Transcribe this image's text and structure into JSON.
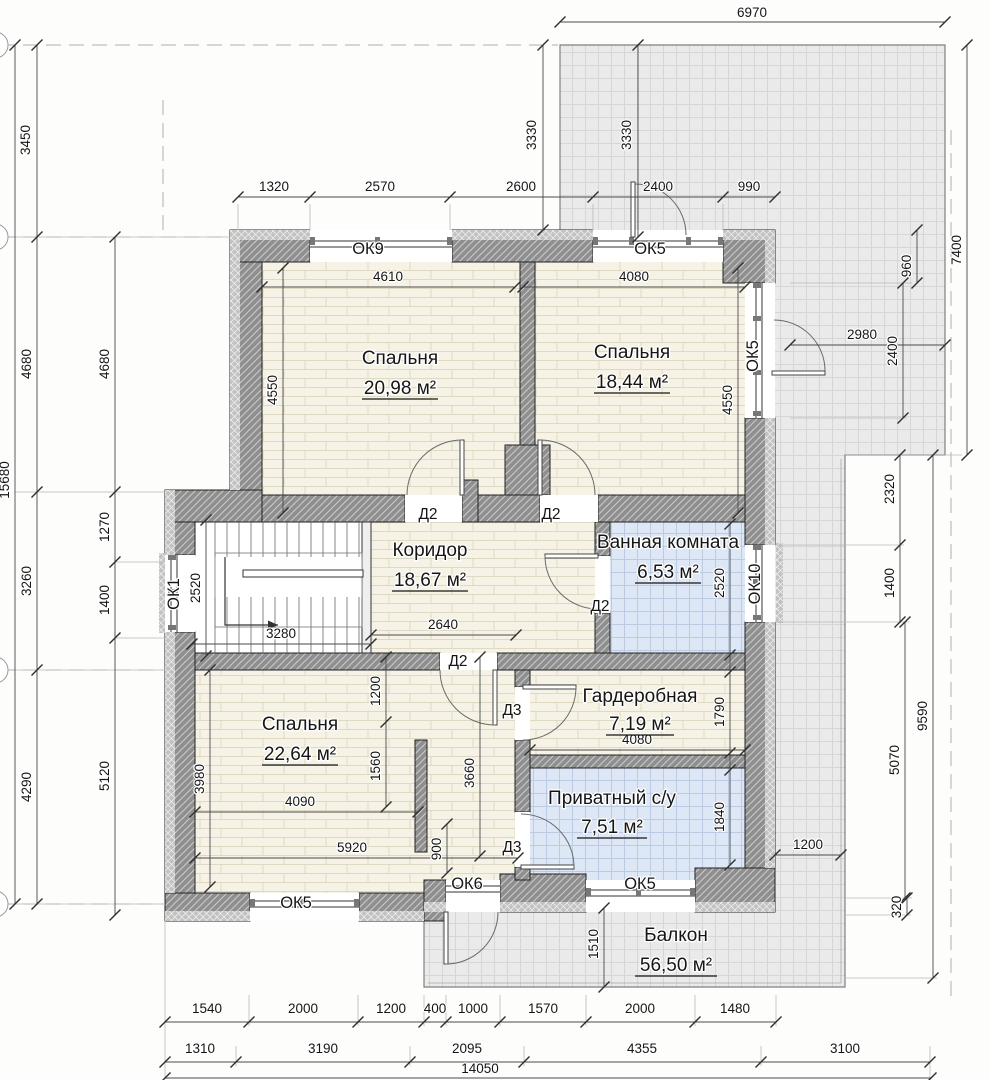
{
  "rooms": [
    {
      "name": "Спальня",
      "area": "20,98 м²"
    },
    {
      "name": "Спальня",
      "area": "18,44 м²"
    },
    {
      "name": "Коридор",
      "area": "18,67 м²"
    },
    {
      "name": "Ванная комната",
      "area": "6,53 м²"
    },
    {
      "name": "Гардеробная",
      "area": "7,19 м²"
    },
    {
      "name": "Приватный с/у",
      "area": "7,51 м²"
    },
    {
      "name": "Спальня",
      "area": "22,64 м²"
    },
    {
      "name": "Балкон",
      "area": "56,50 м²"
    }
  ],
  "windows": [
    "ОК9",
    "ОК5",
    "ОК5",
    "ОК10",
    "ОК1",
    "ОК5",
    "ОК6",
    "ОК5"
  ],
  "doors": [
    "Д2",
    "Д2",
    "Д2",
    "Д2",
    "Д3",
    "Д3"
  ],
  "dims": {
    "top": [
      "6970",
      "3450",
      "3330",
      "3330",
      "1320",
      "2570",
      "2600",
      "2400",
      "990"
    ],
    "left_outer": [
      "15680",
      "4680",
      "3260",
      "4290"
    ],
    "left_inner": [
      "4680",
      "1270",
      "1400",
      "5120"
    ],
    "right": [
      "7400",
      "960",
      "2980",
      "2400",
      "2320",
      "1400",
      "9590",
      "5070",
      "1200",
      "320"
    ],
    "bottom_row1": [
      "1540",
      "2000",
      "1200",
      "400",
      "1000",
      "1570",
      "2000",
      "1480"
    ],
    "bottom_row2": [
      "1310",
      "3190",
      "2095",
      "4355",
      "3100"
    ],
    "bottom_total": "14050",
    "interior": [
      "4610",
      "4550",
      "4080",
      "4550",
      "2520",
      "3280",
      "2640",
      "2520",
      "1790",
      "4080",
      "1840",
      "1200",
      "1560",
      "3660",
      "900",
      "3980",
      "4090",
      "5920",
      "1510"
    ]
  }
}
